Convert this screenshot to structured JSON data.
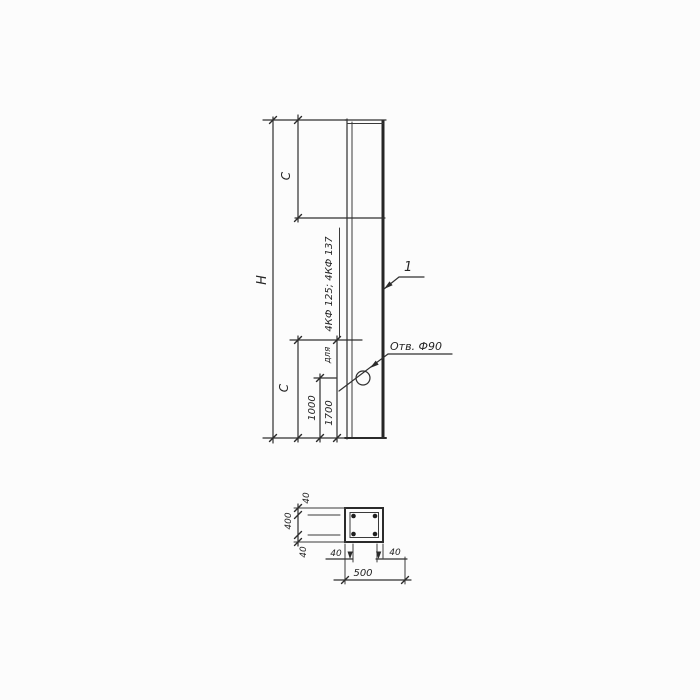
{
  "drawing": {
    "type": "structural column technical drawing",
    "elevation": {
      "height_label": "H",
      "offset_top_label": "C",
      "offset_bottom_label": "C",
      "dim_hole_to_bottom": "1000",
      "dim_line_to_bottom": "1700",
      "note_prefix": "для",
      "note_marks": "4КФ 125; 4КФ 137",
      "hole_label": "Отв. Ф90",
      "item_number": "1"
    },
    "section": {
      "width_total": "500",
      "height_total": "400",
      "inset_top": "40",
      "inset_bottom": "40",
      "inset_left": "40",
      "inset_right": "40"
    },
    "colors": {
      "line": "#2b2b2b",
      "background": "#fcfcfc"
    }
  }
}
